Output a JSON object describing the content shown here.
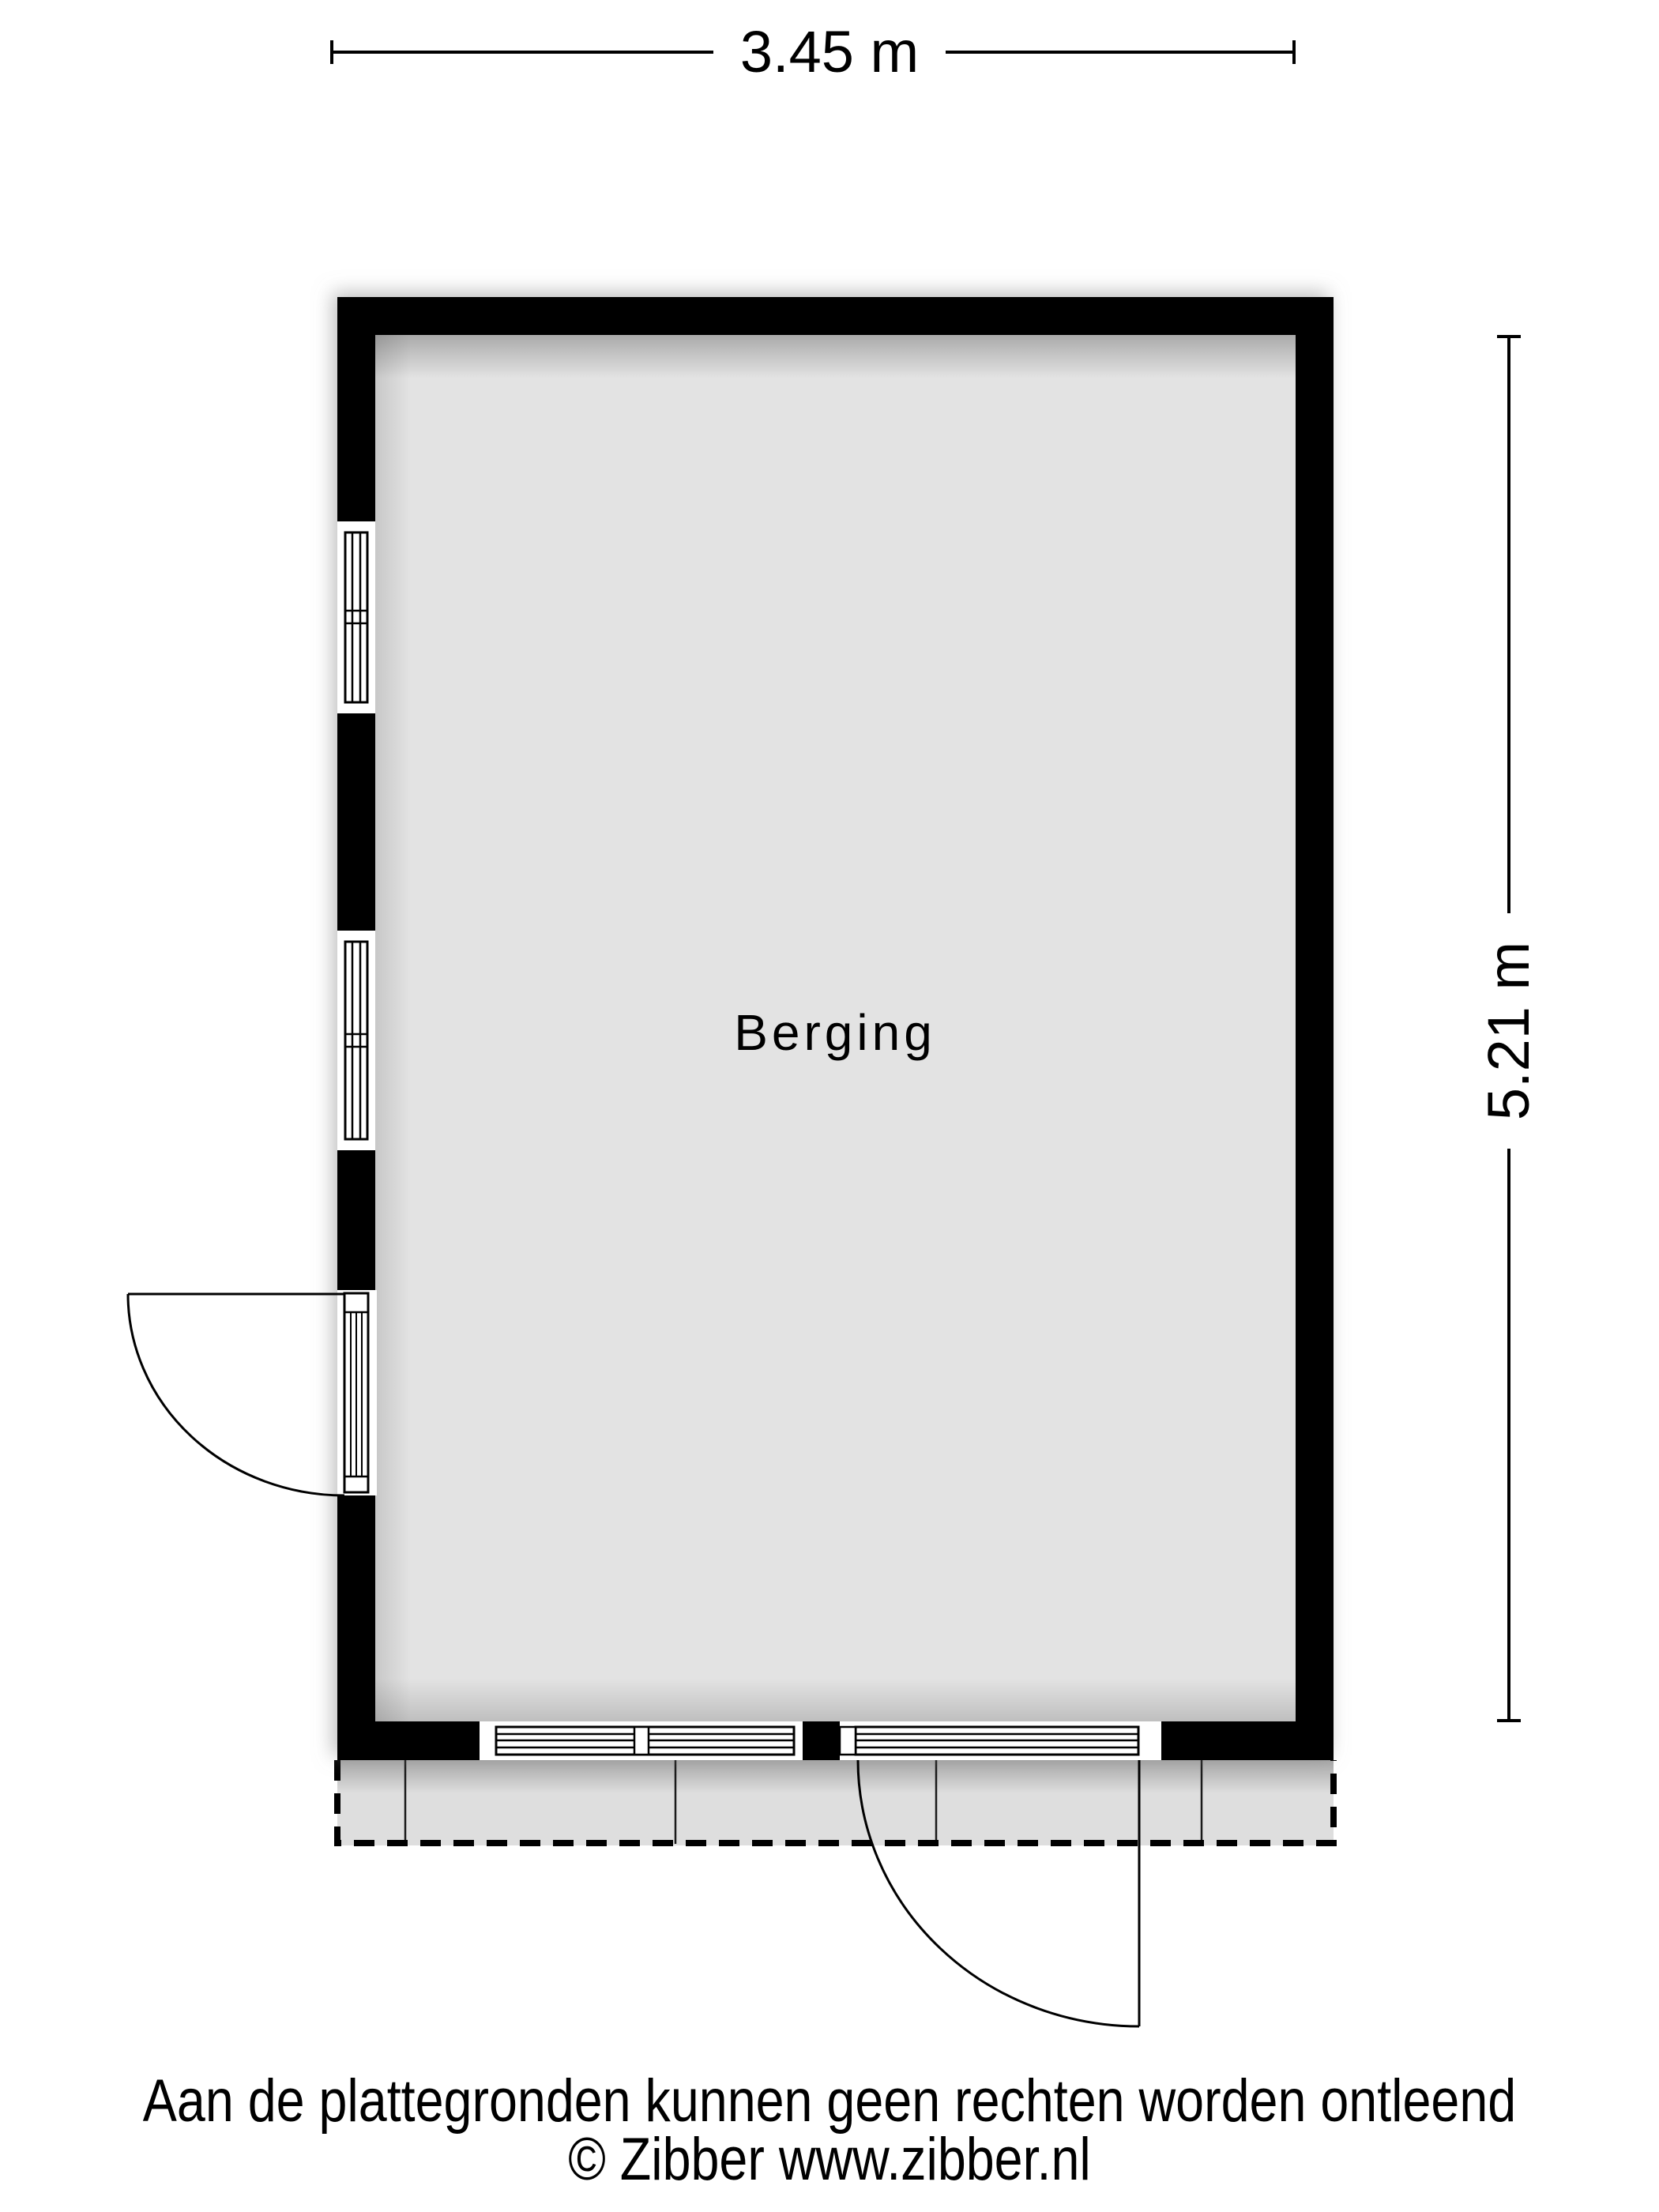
{
  "floor_plan": {
    "room_label": "Berging",
    "dim_width_label": "3.45 m",
    "dim_height_label": "5.21 m",
    "colors": {
      "wall": "#000000",
      "floor": "#e3e3e3",
      "terrace": "#dedede",
      "background": "#ffffff",
      "text": "#000000"
    }
  },
  "footer": {
    "disclaimer": "Aan de plattegronden kunnen geen rechten worden ontleend",
    "copyright": "© Zibber www.zibber.nl"
  }
}
